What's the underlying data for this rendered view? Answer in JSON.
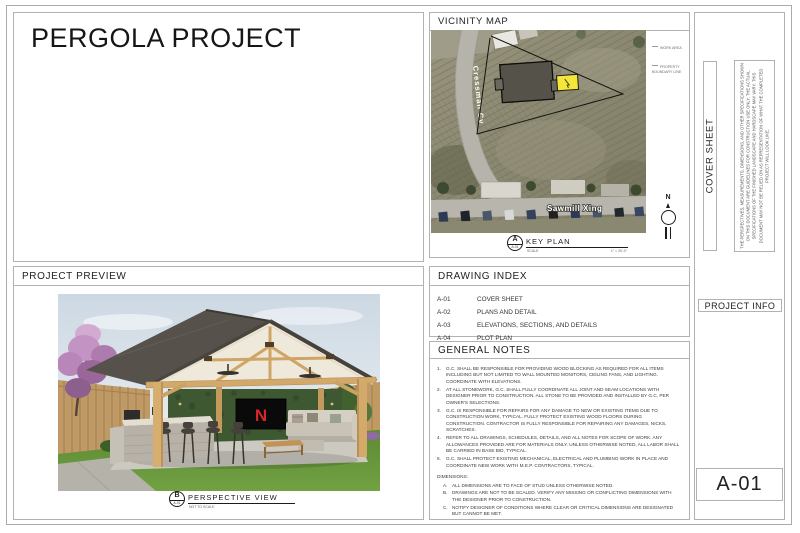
{
  "title_block": {
    "project_title": "PERGOLA PROJECT"
  },
  "preview": {
    "header": "PROJECT PREVIEW",
    "tv_logo": "N",
    "callout": {
      "letter": "B",
      "sheet": "A-01",
      "label": "PERSPECTIVE VIEW",
      "scale": "NOT TO SCALE"
    }
  },
  "vicinity": {
    "header": "VICINITY MAP",
    "streets": {
      "vertical": "Cressman Cv",
      "horizontal": "Sawmill Xing"
    },
    "annotations": {
      "work_area": "WORK AREA",
      "boundary": "PROPERTY BOUNDARY LINE"
    },
    "compass": {
      "north": "N"
    },
    "key_plan": {
      "letter": "A",
      "sheet": "A-01",
      "label": "KEY PLAN",
      "scale_label": "SCALE",
      "scale_value": "1\" = 20'-0\""
    }
  },
  "drawing_index": {
    "header": "DRAWING INDEX",
    "rows": [
      {
        "code": "A-01",
        "name": "COVER SHEET"
      },
      {
        "code": "A-02",
        "name": "PLANS AND DETAIL"
      },
      {
        "code": "A-03",
        "name": "ELEVATIONS, SECTIONS, AND DETAILS"
      },
      {
        "code": "A-04",
        "name": "PLOT PLAN"
      }
    ]
  },
  "general_notes": {
    "header": "GENERAL NOTES",
    "items": [
      {
        "num": "1.",
        "text": "G.C. SHALL BE RESPONSIBLE FOR PROVIDING WOOD BLOCKING AS REQUIRED FOR ALL ITEMS INCLUDING BUT NOT LIMITED TO WALL MOUNTED MONITORS, CEILING FANS, AND LIGHTING. COORDINATE WITH ELEVATIONS."
      },
      {
        "num": "2.",
        "text": "AT ALL STONEWORK, G.C. SHALL FULLY COORDINATE ALL JOINT AND SEAM LOCATIONS WITH DESIGNER PRIOR TO CONSTRUCTION. ALL STONE TO BE PROVIDED AND INSTALLED BY G.C. PER OWNER'S SELECTIONS."
      },
      {
        "num": "3.",
        "text": "G.C. IS RESPONSIBLE FOR REPAIRS FOR ANY DAMAGE TO NEW OR EXISTING ITEMS DUE TO CONSTRUCTION WORK, TYPICAL. FULLY PROTECT EXISTING WOOD FLOORS DURING CONSTRUCTION. CONTRACTOR IS FULLY RESPONSIBLE FOR REPAIRING ANY DAMAGES, NICKS, SCRATCHES."
      },
      {
        "num": "4.",
        "text": "REFER TO ALL DRAWINGS, SCHEDULES, DETAILS, AND ALL NOTES FOR SCOPE OF WORK. ANY ALLOWANCES PROVIDED ARE FOR MATERIALS ONLY. UNLESS OTHERWISE NOTED, ALL LABOR SHALL BE CARRIED IN BASE BID, TYPICAL."
      },
      {
        "num": "5.",
        "text": "G.C. SHALL PROTECT EXISTING MECHANICAL, ELECTRICAL AND PLUMBING WORK IN PLACE AND COORDINATE NEW WORK WITH M.E.P. CONTRACTORS, TYPICAL."
      }
    ],
    "dimensions_header": "DIMENSIONS:",
    "dimension_items": [
      {
        "num": "A.",
        "text": "ALL DIMENSIONS ARE TO FACE OF STUD UNLESS OTHERWISE NOTED."
      },
      {
        "num": "B.",
        "text": "DRAWINGS ARE NOT TO BE SCALED. VERIFY ANY MISSING OR CONFLICTING DIMENSIONS WITH THE DESIGNER PRIOR TO CONSTRUCTION."
      },
      {
        "num": "C.",
        "text": "NOTIFY DESIGNER OF CONDITIONS WHERE CLEAR OR CRITICAL DIMENSIONS ARE DESIGNATED BUT CANNOT BE MET."
      }
    ]
  },
  "side_panel": {
    "sheet_title_vertical": "COVER SHEET",
    "disclaimer": "THE PERSPECTIVES, MEASUREMENTS, DIMENSIONS, AND OTHER SPECIFICATIONS SHOWN ON THIS DOCUMENT ARE GUIDELINES FOR CONSTRUCTION USE ONLY. THE ACTUAL SPECIFICATIONS OF THE FINISHED LANDSCAPE AND HARDSCAPE MAY VARY. THIS DOCUMENT MAY NOT BE RELIED ON AS REPRESENTATION OF WHAT THE COMPLETED PROJECT WILL LOOK LIKE.",
    "project_info_label": "PROJECT INFO",
    "sheet_number": "A-01"
  },
  "colors": {
    "line_gray": "#b2b2b2",
    "work_area_yellow": "#f5e73a",
    "tv_logo_red": "#d7252b"
  }
}
